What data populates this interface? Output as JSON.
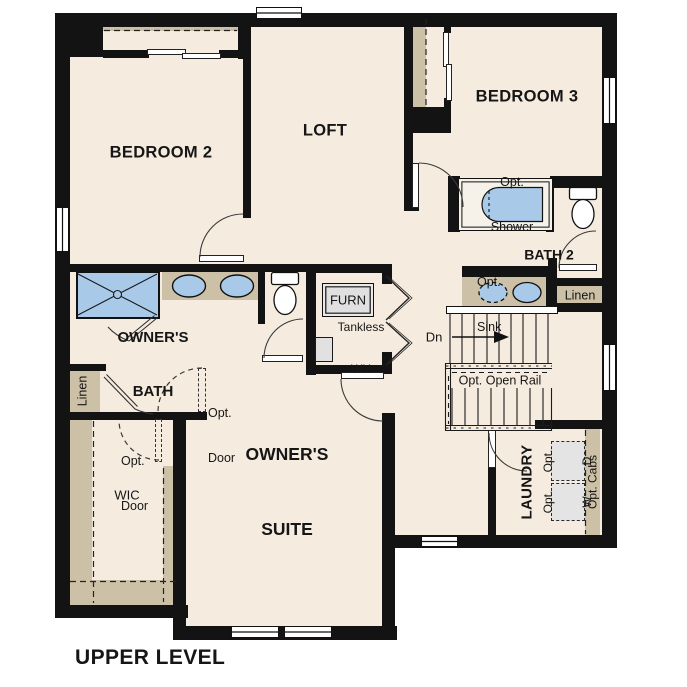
{
  "title": "UPPER LEVEL",
  "colors": {
    "floor": "#f5ecdf",
    "wall": "#131313",
    "cabinet_tan": "#ccc0a6",
    "fixture_blue": "#a9c9e9",
    "appliance_gray": "#e1e1e1"
  },
  "rooms": {
    "bedroom2": "BEDROOM 2",
    "loft": "LOFT",
    "bedroom3": "BEDROOM 3",
    "owners_bath": {
      "line1": "OWNER'S",
      "line2": "BATH"
    },
    "bath2": "BATH 2",
    "owners_suite": {
      "line1": "OWNER'S",
      "line2": "SUITE"
    },
    "laundry": "LAUNDRY",
    "wic": "WIC"
  },
  "features": {
    "opt_shower": {
      "line1": "Opt.",
      "line2": "Shower"
    },
    "opt_sink": {
      "line1": "Opt.",
      "line2": "Sink"
    },
    "linen_bath2": "Linen",
    "linen_owners_bath": "Linen",
    "furnace": "FURN",
    "tankless_wh": {
      "line1": "Tankless",
      "line2": "WH"
    },
    "stairs_down": "Dn",
    "opt_open_rail": "Opt. Open Rail",
    "opt_door": {
      "line1": "Opt.",
      "line2": "Door"
    },
    "opt_washer": {
      "line1": "Opt.",
      "line2": "W"
    },
    "opt_dryer": {
      "line1": "Opt.",
      "line2": "D"
    },
    "opt_cabs": "Opt. Cabs"
  }
}
